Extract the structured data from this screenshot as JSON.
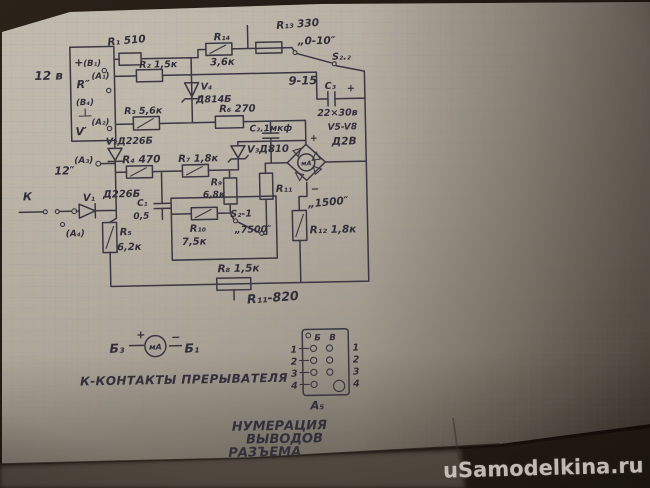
{
  "photo": {
    "watermark": "uSamodelkina.ru"
  },
  "colors": {
    "ink": "#37343f",
    "paper": "#a69f92",
    "grid": "#8893a0",
    "watermark": "#d6d0c9",
    "background": "#1c1510"
  },
  "schematic": {
    "power": {
      "supply": "12 в",
      "plus": "+",
      "b1": "(В₁)",
      "r": "R″",
      "a1": "(А₁)",
      "b4": "(В₄)",
      "v": "V′",
      "a2": "(А₂)"
    },
    "top": {
      "r1": "R₁ 510",
      "r2": "R₂ 1,5к",
      "r3": "R₃ 5,6к",
      "v4": "V₄",
      "v4_type": "Д814Б",
      "r14": "R₁₄",
      "r14_val": "3,6к",
      "r13": "R₁₃ 330",
      "scale_0_10": "„0-10″",
      "s22": "S₂.₂",
      "scale_9_15": "9-15",
      "c3": "С₃",
      "c3_plus": "+",
      "c3_val": "22×30в",
      "v5_v8": "V5-V8",
      "v5_v8_type": "Д2В",
      "r6": "R₆ 270",
      "c2": "С₂.1мкф"
    },
    "mid": {
      "v2": "V₂Д226Б",
      "r4": "R₄ 470",
      "r7": "R₇ 1,8к",
      "v3": "V₃Д810",
      "t12": "12″",
      "a3": "(А₃)",
      "v1": "V₁",
      "v1_type": "Д226Б",
      "c1": "С₁",
      "c1_val": "0,5",
      "r9": "R₉",
      "r9_val": "6,8к",
      "r11": "R₁₁",
      "s21": "S₂-1",
      "s21_val": "„7500″",
      "r10": "R₁₀",
      "r10_val": "7,5к",
      "scale_1500": "„1500″",
      "r12": "R₁₂ 1,8к",
      "k": "К",
      "a4": "(А₄)",
      "r5": "R₅",
      "r5_val": "6,2к",
      "bridge_plus": "+",
      "bridge_minus": "−",
      "meter": "мА"
    },
    "bottom": {
      "r8": "R₈ 1,5к",
      "r11_note": "R₁₁-820",
      "b3": "Б₃",
      "plus": "+",
      "meter": "мА",
      "minus": "−",
      "b1": "Б₁",
      "contacts_note": "К-КОНТАКТЫ ПРЕРЫВАТЕЛЯ"
    },
    "connector": {
      "header_b": "Б",
      "header_v": "В",
      "left": [
        "1",
        "2",
        "3",
        "4"
      ],
      "right": [
        "1",
        "2",
        "3",
        "4"
      ],
      "bottom_label": "А₅",
      "title_1": "НУМЕРАЦИЯ",
      "title_2": "ВЫВОДОВ",
      "title_3": "РАЗЪЕМА"
    }
  }
}
